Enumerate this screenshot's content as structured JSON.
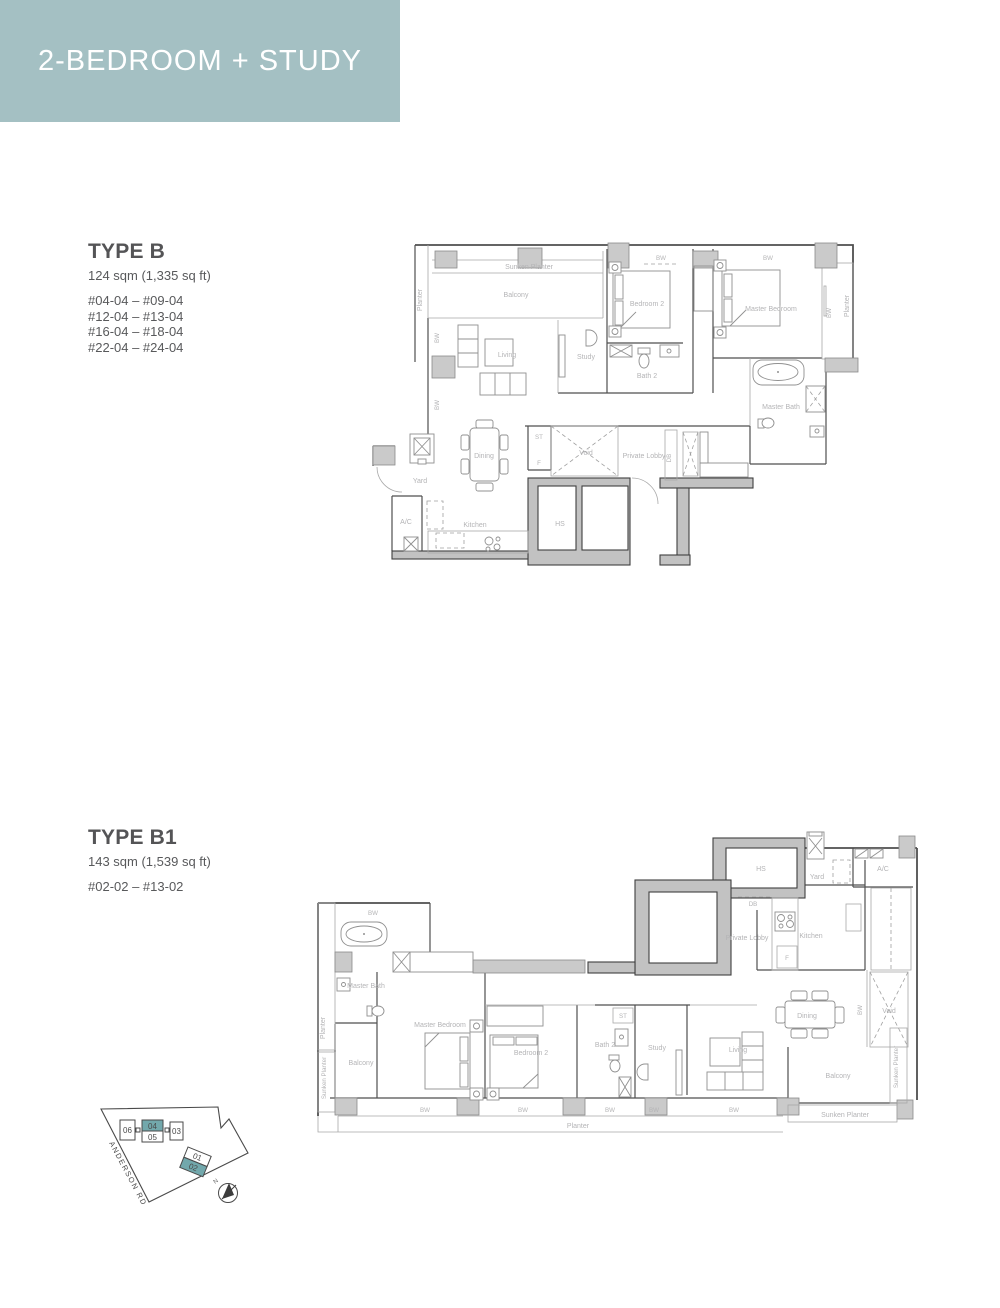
{
  "header": {
    "title": "2-BEDROOM + STUDY"
  },
  "type_b": {
    "name": "TYPE B",
    "area": "124 sqm (1,335 sq ft)",
    "units": [
      "#04-04 – #09-04",
      "#12-04 – #13-04",
      "#16-04 – #18-04",
      "#22-04 – #24-04"
    ]
  },
  "type_b1": {
    "name": "TYPE B1",
    "area": "143 sqm (1,539 sq ft)",
    "units": [
      "#02-02 – #13-02"
    ]
  },
  "room_labels": {
    "sunken_planter": "Sunken Planter",
    "planter": "Planter",
    "balcony": "Balcony",
    "living": "Living",
    "study": "Study",
    "bedroom2": "Bedroom 2",
    "master_bedroom": "Master Bedroom",
    "bath2": "Bath 2",
    "master_bath": "Master Bath",
    "dining": "Dining",
    "yard": "Yard",
    "ac": "A/C",
    "kitchen": "Kitchen",
    "st": "ST",
    "f": "F",
    "void": "Void",
    "private_lobby": "Private Lobby",
    "db": "DB",
    "hs": "HS",
    "bw": "BW"
  },
  "key_plan": {
    "road": "ANDERSON RD",
    "north": "N",
    "units": [
      "06",
      "04",
      "05",
      "03",
      "01",
      "02"
    ],
    "highlighted_units": [
      "04",
      "02"
    ]
  },
  "colors": {
    "header_bg": "#a4c0c3",
    "header_text": "#ffffff",
    "unit_highlight": "#72a8ac",
    "heading_text": "#58595b",
    "plan_label": "#b4b4b6"
  }
}
